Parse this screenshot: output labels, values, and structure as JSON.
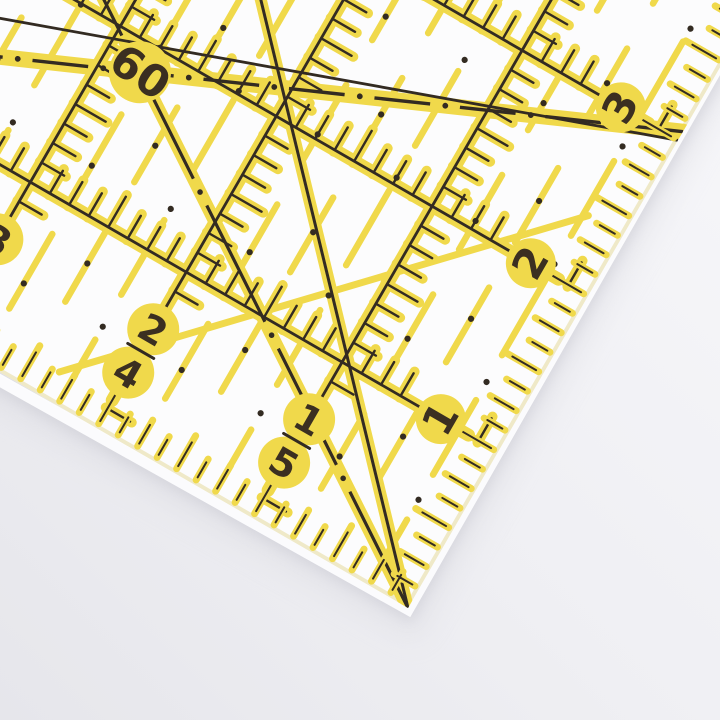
{
  "scene": {
    "alt_text": "Corner of a transparent quilting ruler with yellow and black grid markings lying on a white surface"
  },
  "colors": {
    "background_top": "#f7f7fa",
    "background_bottom": "#e6e6eb",
    "ruler_body": "#fcfcfd",
    "marking_yellow": "#f0d94b",
    "marking_black": "#332b22",
    "number_ink": "#3b2f21",
    "edge_tint": "#efe9c8",
    "edge_highlight": "#ffffff",
    "shadow": "#c9c9d2"
  },
  "ruler": {
    "angle_label": "60",
    "bottom_scale_pairs": [
      {
        "top": "1",
        "bottom": "5"
      },
      {
        "top": "2",
        "bottom": "4"
      },
      {
        "top": "3",
        "bottom": "3"
      }
    ],
    "right_scale_labels": [
      "1",
      "2",
      "3"
    ]
  }
}
